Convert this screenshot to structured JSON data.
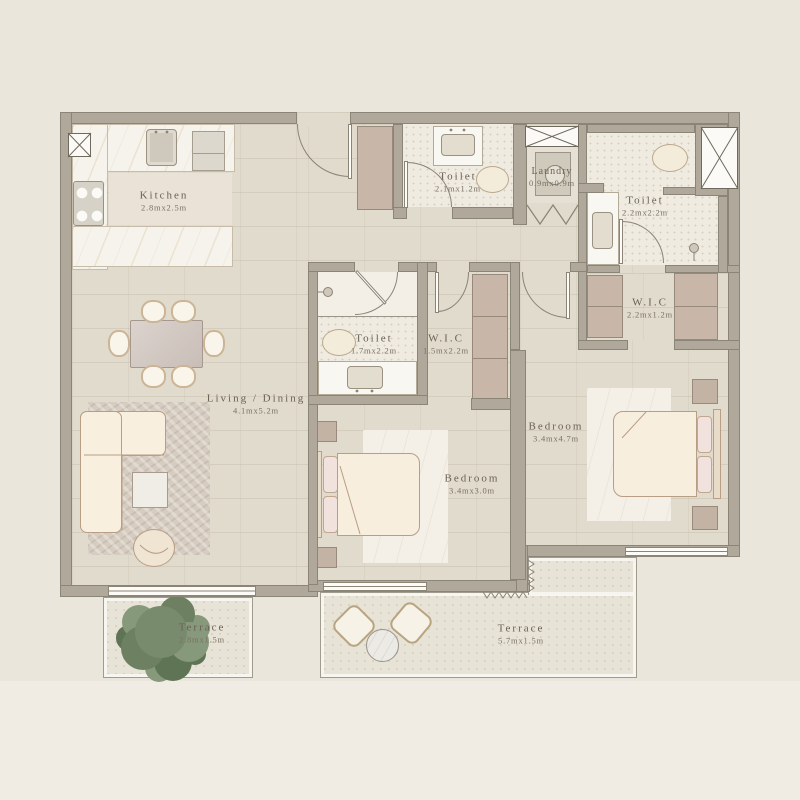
{
  "plan": {
    "rooms": {
      "kitchen": {
        "name": "Kitchen",
        "dims": "2.8mx2.5m"
      },
      "living_dining": {
        "name": "Living / Dining",
        "dims": "4.1mx5.2m"
      },
      "toilet_entry": {
        "name": "Toilet",
        "dims": "2.1mx1.2m"
      },
      "laundry": {
        "name": "Laundry",
        "dims": "0.9mx0.9m"
      },
      "toilet_master": {
        "name": "Toilet",
        "dims": "2.2mx2.2m"
      },
      "wic_master": {
        "name": "W.I.C",
        "dims": "2.2mx1.2m"
      },
      "toilet_mid": {
        "name": "Toilet",
        "dims": "1.7mx2.2m"
      },
      "wic_mid": {
        "name": "W.I.C",
        "dims": "1.5mx2.2m"
      },
      "bedroom_mid": {
        "name": "Bedroom",
        "dims": "3.4mx3.0m"
      },
      "bedroom_master": {
        "name": "Bedroom",
        "dims": "3.4mx4.7m"
      },
      "terrace_left": {
        "name": "Terrace",
        "dims": "2.8mx1.5m"
      },
      "terrace_right": {
        "name": "Terrace",
        "dims": "5.7mx1.5m"
      }
    },
    "palette": {
      "background": "#ece7de",
      "wall": "#b0a89a",
      "floor": "#e1dbcd",
      "wet_floor": "#efebe1",
      "terrace_floor": "#e8e3d7",
      "marble": "#f6f3ec",
      "wardrobe": "#c8b7a8",
      "furniture_outline": "#b79e85",
      "plant": "#798b6d",
      "label_text": "#6b6154"
    }
  }
}
